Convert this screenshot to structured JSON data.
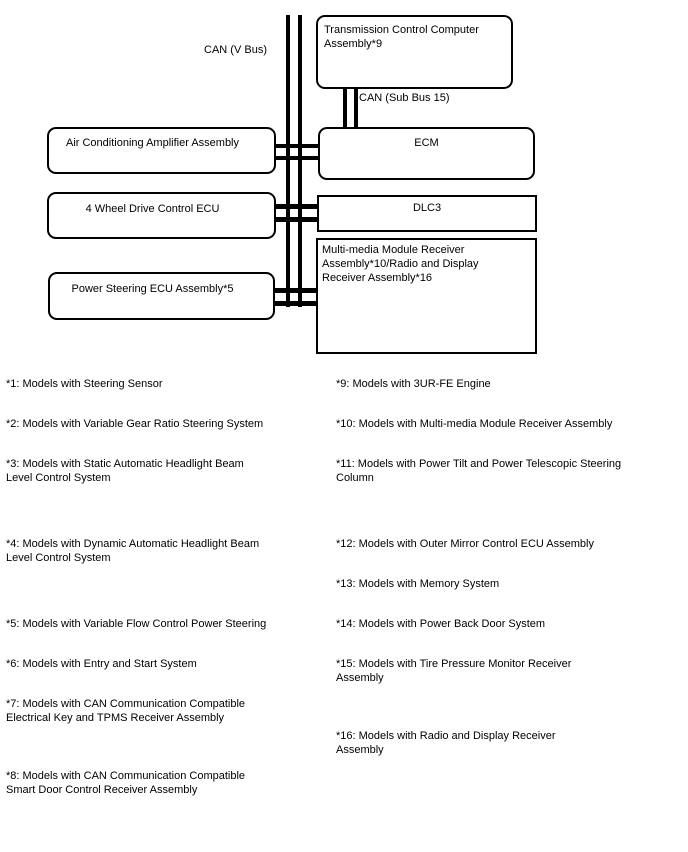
{
  "diagram": {
    "bus_label": "CAN (V Bus)",
    "sub_bus_label": "CAN (Sub Bus 15)",
    "nodes": {
      "transmission": "Transmission Control Computer\nAssembly*9",
      "air_conditioning": "Air Conditioning Amplifier Assembly",
      "ecm": "ECM",
      "four_wheel_drive": "4 Wheel Drive Control ECU",
      "dlc3": "DLC3",
      "power_steering": "Power Steering ECU Assembly*5",
      "multimedia": "Multi-media Module Receiver\nAssembly*10/Radio and Display\nReceiver Assembly*16"
    },
    "colors": {
      "line": "#000000",
      "background": "#ffffff",
      "text": "#000000"
    }
  },
  "footnotes": {
    "left": [
      "*1: Models with Steering Sensor",
      "*2: Models with Variable Gear Ratio Steering System",
      "*3: Models with Static Automatic Headlight Beam\nLevel Control System",
      "*4: Models with Dynamic Automatic Headlight Beam\nLevel Control System",
      "*5: Models with Variable Flow Control Power Steering",
      "*6: Models with Entry and Start System",
      "*7: Models with CAN Communication Compatible\nElectrical Key and TPMS Receiver Assembly",
      "*8: Models with CAN Communication Compatible\nSmart Door Control Receiver Assembly"
    ],
    "right": [
      "*9: Models with 3UR-FE Engine",
      "*10: Models with Multi-media Module Receiver Assembly",
      "*11: Models with Power Tilt and Power Telescopic Steering\nColumn",
      "*12: Models with Outer Mirror Control ECU Assembly",
      "*13: Models with Memory System",
      "*14: Models with Power Back Door System",
      "*15: Models with Tire Pressure Monitor Receiver\nAssembly",
      "*16: Models with Radio and Display Receiver\nAssembly"
    ]
  }
}
